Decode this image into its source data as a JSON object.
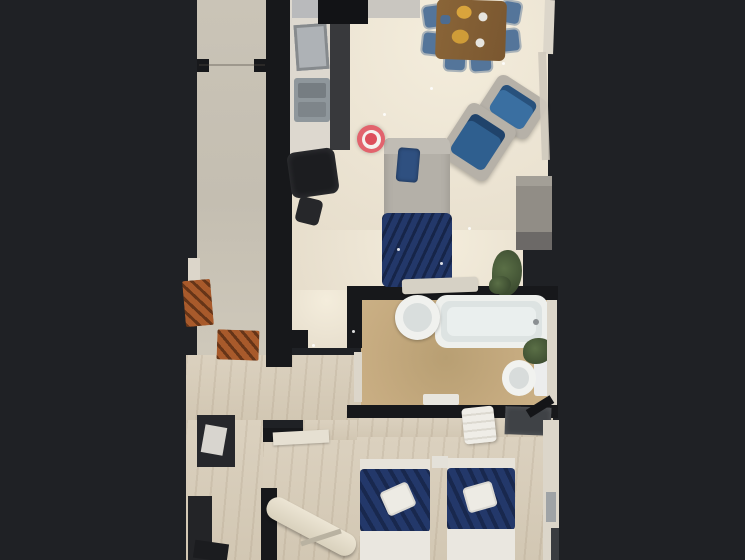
{
  "viewer": {
    "type": "3d-floorplan-top-down-view",
    "marker": {
      "name": "position-marker",
      "shape": "bullseye",
      "visible": true
    }
  },
  "palette": {
    "bg": "#1f2125",
    "wall": "#17181b",
    "mat": "#a85a2b",
    "chairBlue": "#54759a",
    "markerOuter": "#e2636d",
    "markerRing": "#f5f1ee",
    "markerCenter": "#dd4e5b",
    "navyBlanket": "#23386a",
    "armchairBlue": "#3a6fa1",
    "sofaGray": "#b4b0a8",
    "frameGray": "#b6b1a8",
    "tableWood": "#84603a",
    "bathTan": "#c6ab80",
    "livingCream": "#ece4d3",
    "hallStone": "#c6c0b3",
    "woodFloor": "#d7cdbb",
    "plantGreen": "#45573a",
    "counterWhite": "#ddd8cf",
    "kitchenDark": "#38393c",
    "steelSink": "#8f979c"
  },
  "rooms": [
    {
      "name": "hallway"
    },
    {
      "name": "kitchen"
    },
    {
      "name": "living-room"
    },
    {
      "name": "dining-area"
    },
    {
      "name": "bathroom"
    },
    {
      "name": "corridor"
    },
    {
      "name": "bedroom"
    },
    {
      "name": "entry-room"
    }
  ],
  "furniture": [
    "kitchen-counter",
    "kitchen-sink",
    "black-chair",
    "dining-table",
    "dining-chair",
    "armchair",
    "sofa-bed",
    "blue-cushion",
    "navy-blanket",
    "coffee-bench",
    "shelf",
    "doormat",
    "bathtub",
    "wash-basin",
    "toilet",
    "plant",
    "twin-bed",
    "folded-towel",
    "towel-stack",
    "ironing-board",
    "wardrobe",
    "desk"
  ]
}
